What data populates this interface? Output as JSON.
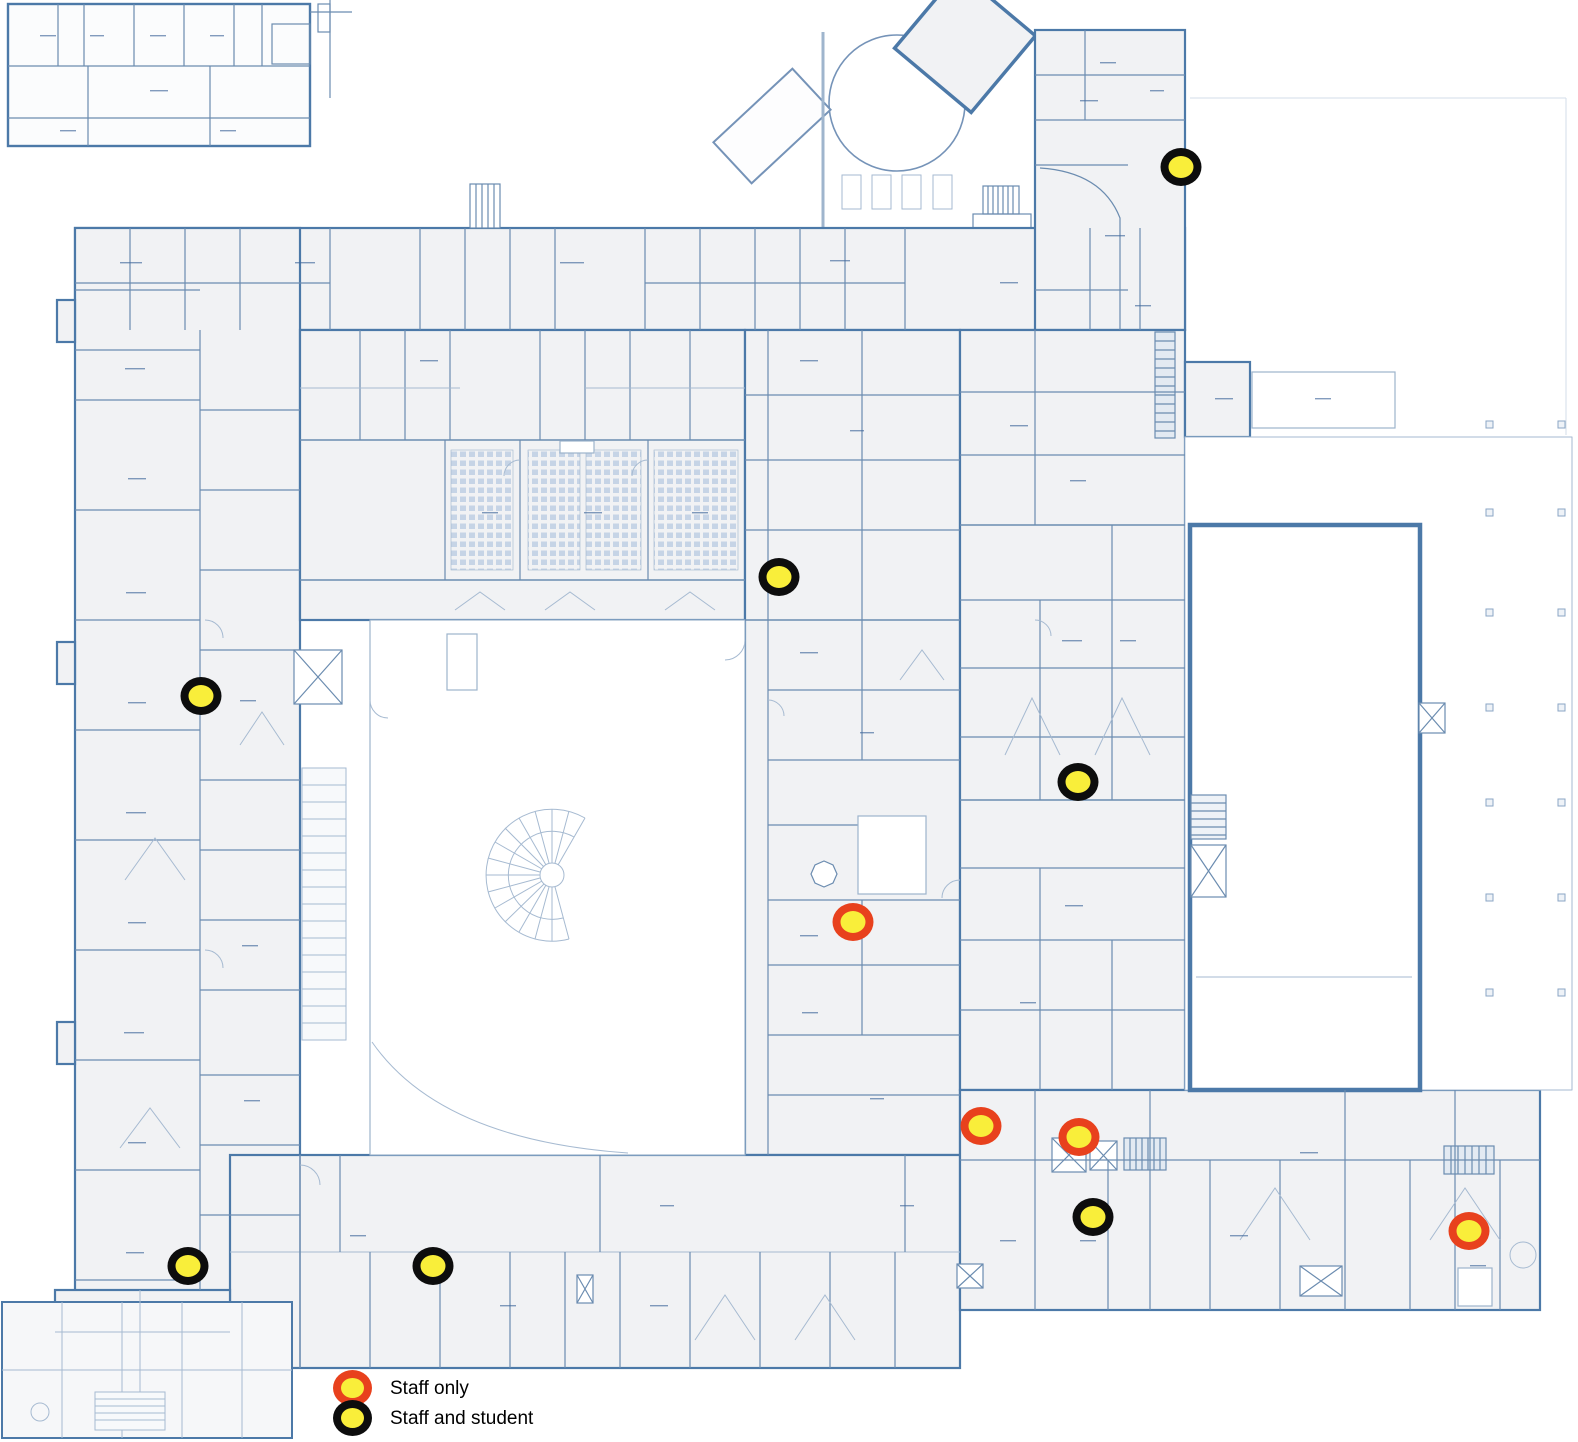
{
  "legend": {
    "items": [
      {
        "id": "staff-only",
        "label": "Staff only",
        "fill": "#f9ee3a",
        "border": "#e8411d"
      },
      {
        "id": "staff-and-student",
        "label": "Staff and student",
        "fill": "#f9ee3a",
        "border": "#0d0d0d"
      }
    ]
  },
  "markers": [
    {
      "type": "staff-only",
      "x": 853,
      "y": 922
    },
    {
      "type": "staff-only",
      "x": 981,
      "y": 1126
    },
    {
      "type": "staff-only",
      "x": 1079,
      "y": 1137
    },
    {
      "type": "staff-only",
      "x": 1469,
      "y": 1231
    },
    {
      "type": "staff-and-student",
      "x": 1181,
      "y": 167
    },
    {
      "type": "staff-and-student",
      "x": 779,
      "y": 577
    },
    {
      "type": "staff-and-student",
      "x": 201,
      "y": 696
    },
    {
      "type": "staff-and-student",
      "x": 1078,
      "y": 782
    },
    {
      "type": "staff-and-student",
      "x": 1093,
      "y": 1217
    },
    {
      "type": "staff-and-student",
      "x": 188,
      "y": 1266
    },
    {
      "type": "staff-and-student",
      "x": 433,
      "y": 1266
    }
  ],
  "plan": {
    "wall_color": "#4c79a8",
    "inner_wall_color": "#6b8cb0",
    "detail_color": "#a6bad1",
    "room_fill": "#f1f2f4",
    "background": "#ffffff",
    "marker_fill": "#f9ee3a"
  }
}
